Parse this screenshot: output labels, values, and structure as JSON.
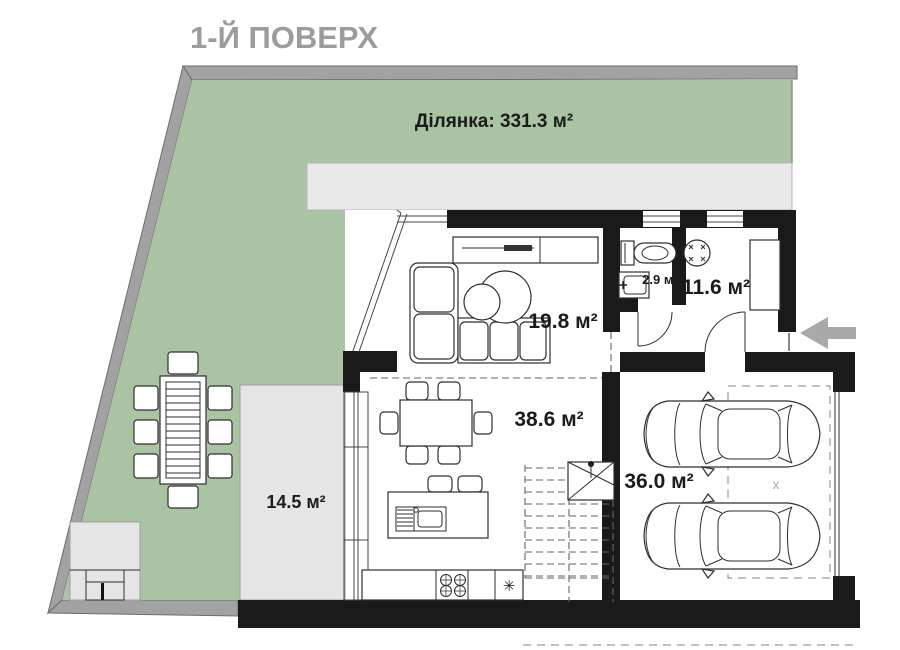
{
  "title": {
    "text": "1-Й ПОВЕРХ"
  },
  "plot": {
    "label": "Ділянка: 331.3 м²"
  },
  "rooms": {
    "living": {
      "area_label": "19.8 м²"
    },
    "wc": {
      "area_label": "2.9 м²"
    },
    "hall": {
      "area_label": "11.6 м²"
    },
    "kitchen": {
      "area_label": "38.6 м²"
    },
    "terrace": {
      "area_label": "14.5 м²"
    },
    "garage": {
      "area_label": "36.0 м²"
    }
  },
  "symbols": {
    "fridge_snowflake": "✳",
    "garage_center_mark": "x"
  },
  "colors": {
    "lawn": "#a9c3a3",
    "paving": "#e9e9e9",
    "terrace_paving": "#e5e5e5",
    "boundary": "#a2a2a2",
    "walls": "#1a1a1a",
    "title_gray": "#9c9c9c",
    "entrance_arrow": "#a9a9a9"
  }
}
